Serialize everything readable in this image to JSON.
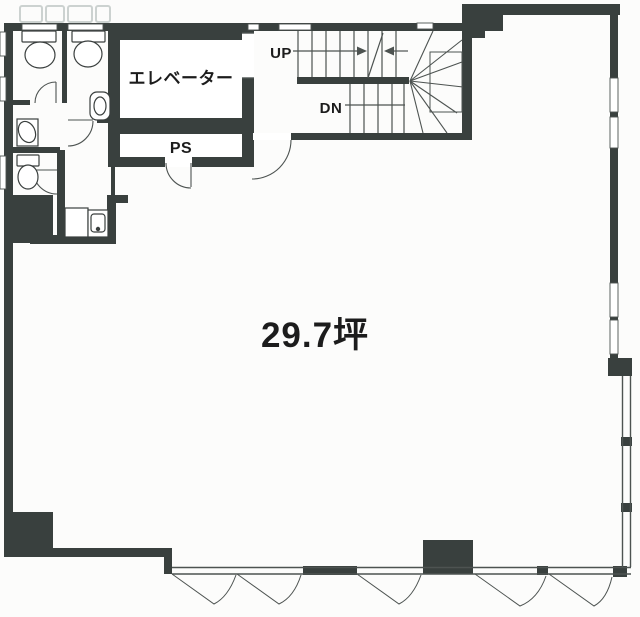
{
  "document": {
    "type": "building-floor-plan"
  },
  "labels": {
    "elevator": "エレベーター",
    "pipe_shaft": "PS",
    "stairs_up": "UP",
    "stairs_down": "DN",
    "floor_area": "29.7坪"
  },
  "colors": {
    "wall": "#39403e",
    "line": "#4d5351",
    "fixture_line": "#3a3f3e",
    "text": "#1c1c1c",
    "background": "#fcfcfb",
    "watermark": "#ccd2d0"
  }
}
